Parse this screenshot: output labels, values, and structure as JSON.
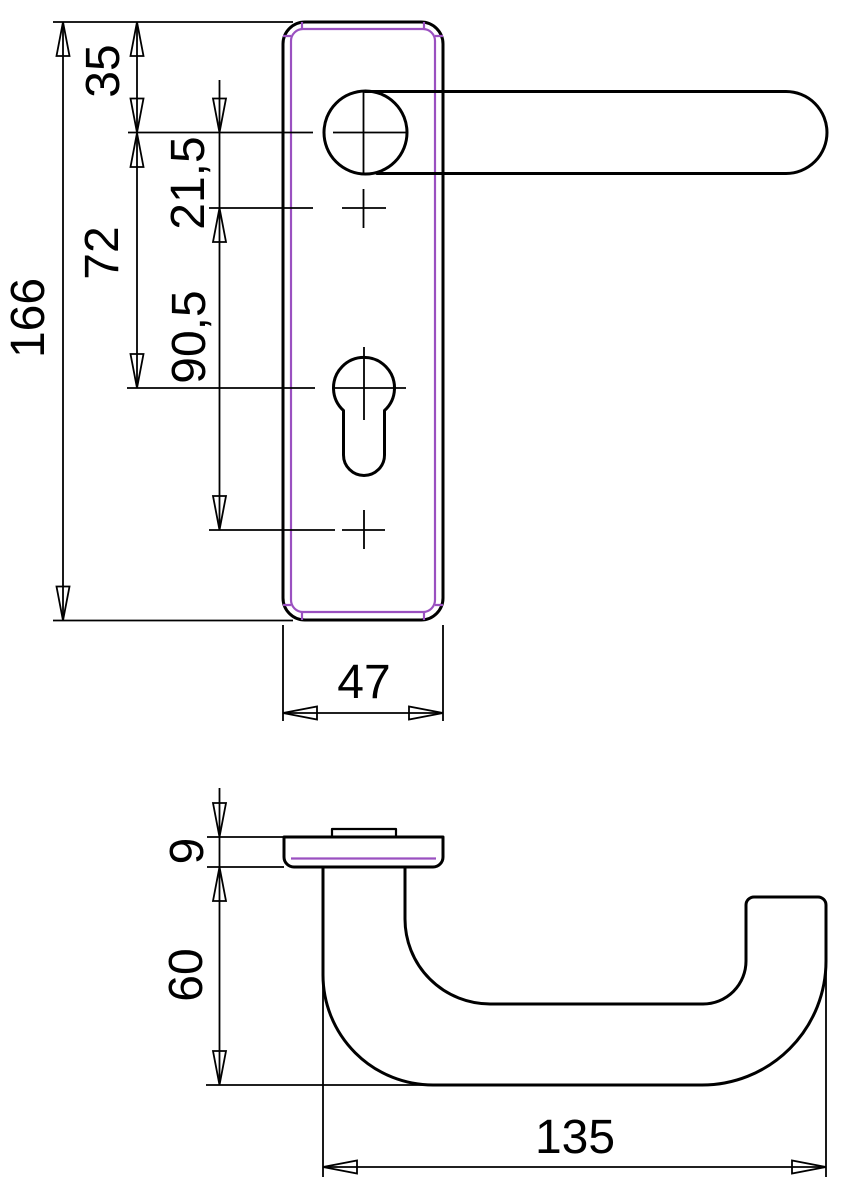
{
  "title": "door-lever-handle-technical-drawing",
  "colors": {
    "line": "#000000",
    "accent": "#9a50c0",
    "background": "#ffffff"
  },
  "dimensions": {
    "overall_plate_height": "166",
    "plate_top_to_handle_center": "35",
    "handle_center_to_cylinder": "72",
    "handle_center_to_upper_screw": "21,5",
    "screw_spacing": "90,5",
    "plate_width": "47",
    "plate_thickness": "9",
    "handle_projection": "60",
    "handle_length": "135"
  }
}
